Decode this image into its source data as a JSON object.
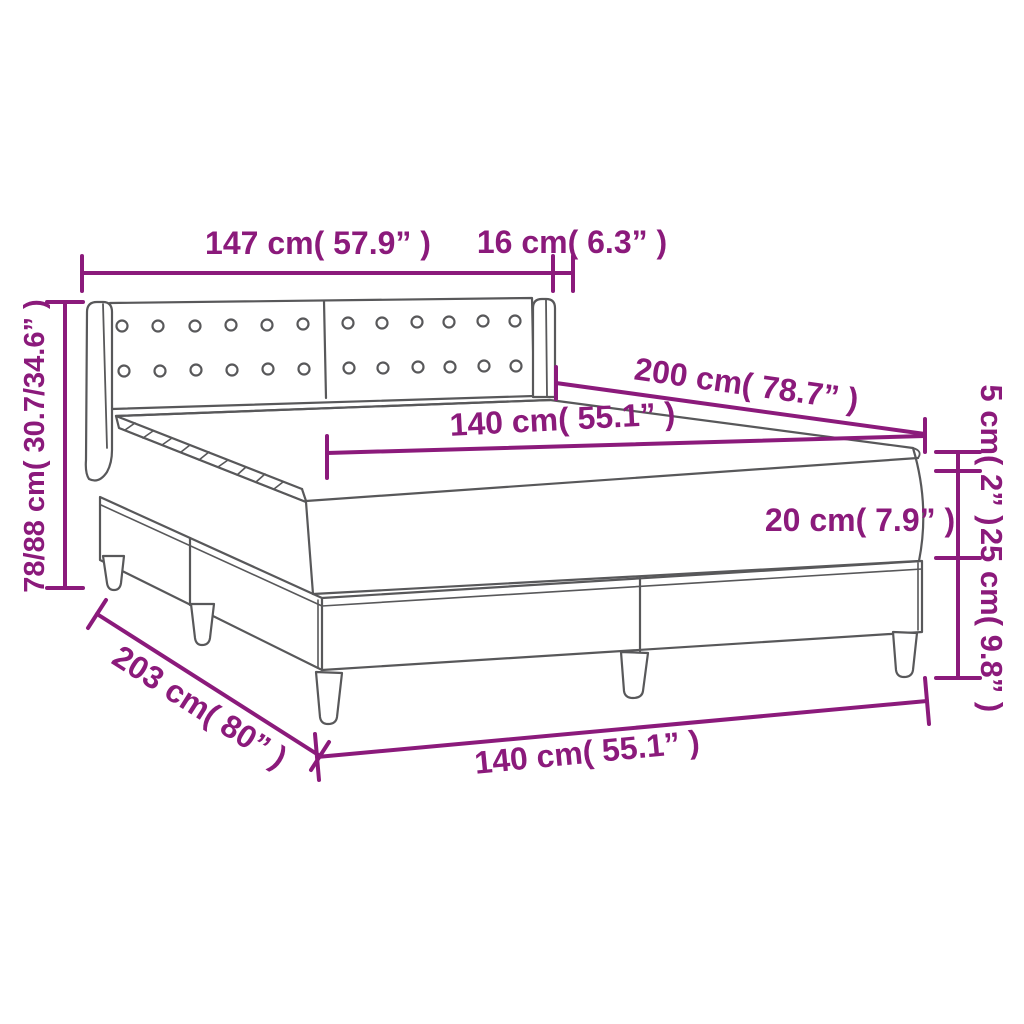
{
  "diagram": {
    "type": "product dimension diagram",
    "subject": "box spring bed with tufted headboard, mattress and topper",
    "colors": {
      "dimension_color": "#8B1A7B",
      "line_art_color": "#58585A",
      "background": "#FFFFFF"
    },
    "dims": {
      "headboard_width": "147 cm( 57.9” )",
      "wing_depth": "16 cm( 6.3” )",
      "headboard_height": "78/88 cm( 30.7/34.6” )",
      "bed_length": "200 cm( 78.7” )",
      "mattress_width": "140 cm( 55.1” )",
      "topper_height": "5 cm( 2” )",
      "mattress_height": "20 cm( 7.9” )",
      "base_height": "25 cm( 9.8” )",
      "base_length": "203 cm( 80” )",
      "base_width": "140 cm( 55.1” )"
    }
  }
}
